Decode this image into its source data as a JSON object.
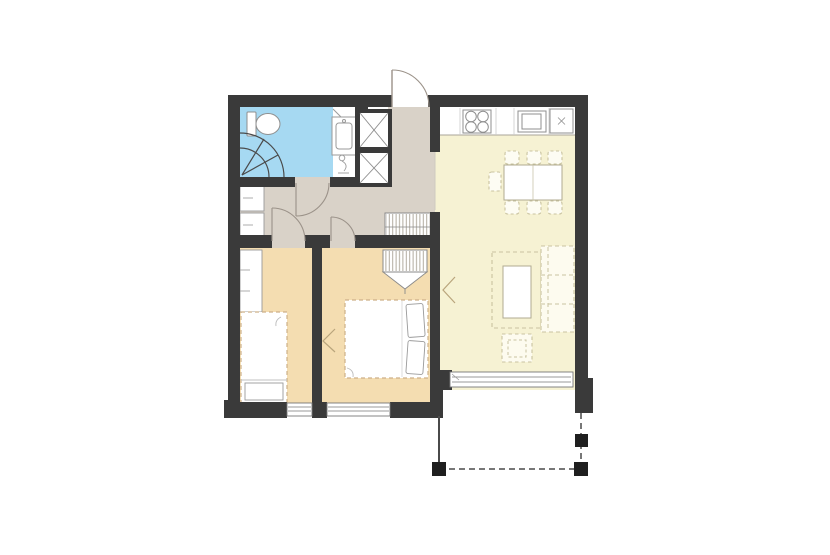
{
  "plan": {
    "kind": "apartment floor plan",
    "rooms": [
      {
        "name": "bathroom",
        "fixtures": [
          "toilet",
          "corner-shower",
          "vanity-sink",
          "faucet-fixture"
        ]
      },
      {
        "name": "entrance-hall",
        "fixtures": [
          "entrance-door",
          "duct-shaft-upper",
          "duct-shaft-lower",
          "hall-cabinet",
          "hall-wardrobe"
        ]
      },
      {
        "name": "kitchen-living-room",
        "fixtures": [
          "kitchen-counter",
          "stove",
          "kitchen-sink",
          "small-appliance",
          "dining-table",
          "dining-chairs",
          "rug",
          "coffee-table",
          "sofa",
          "side-table",
          "wall-tv",
          "balcony-door"
        ]
      },
      {
        "name": "bedroom-1",
        "fixtures": [
          "desk",
          "single-bed",
          "window"
        ]
      },
      {
        "name": "bedroom-2",
        "fixtures": [
          "wardrobe",
          "double-bed",
          "wall-tv",
          "window"
        ]
      },
      {
        "name": "balcony",
        "fixtures": [
          "corner-posts",
          "dashed-railing"
        ]
      }
    ],
    "dining_chair_count": 7,
    "sofa_seat_count": 3,
    "stove_burner_count": 4
  },
  "palette": {
    "background": "#ffffff",
    "wall": "#3a3a3a",
    "wall_dark_post": "#1f1f1f",
    "bathroom_floor": "#a6d9f2",
    "hallway_floor": "#d9d2c8",
    "kitchen_floor": "#f6f2d3",
    "bedroom_floor": "#f4ddb1",
    "fixture_white": "#ffffff",
    "fixture_stroke": "#8f8f8f",
    "door_arc": "#9b9289",
    "furniture_dash_yellow": "#c9c3a0",
    "furniture_dash_tan": "#cdb089",
    "tv_mark": "#b9a57c",
    "balcony_line": "#4a4a4a"
  }
}
